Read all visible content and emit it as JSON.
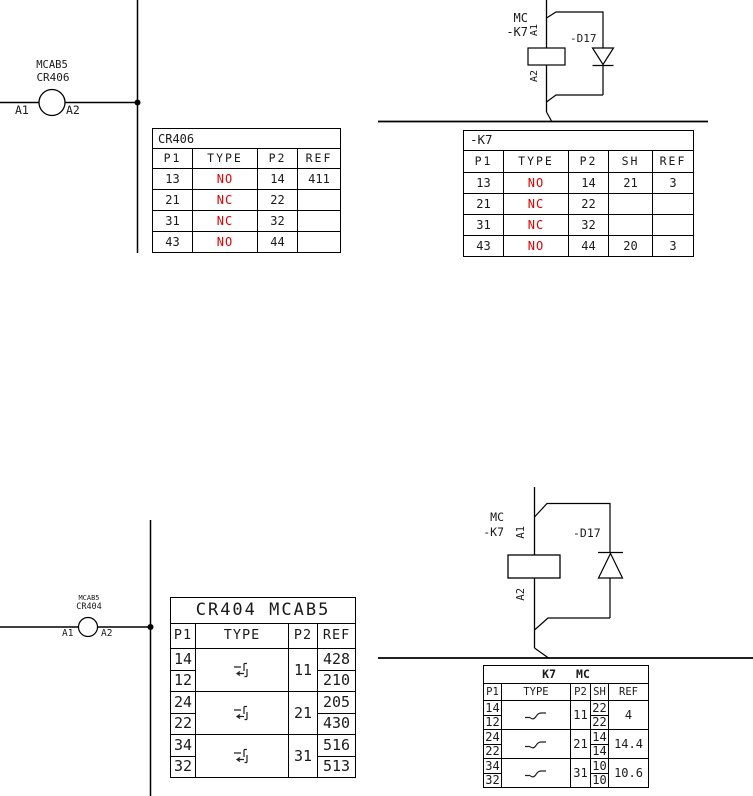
{
  "colors": {
    "wire": "#000000",
    "contact_state_red": "#e00000",
    "background": "#ffffff"
  },
  "coils": {
    "top_left": {
      "line1": "MCAB5",
      "line2": "CR406",
      "a1": "A1",
      "a2": "A2"
    },
    "top_right": {
      "line1": "MC",
      "line2": "-K7",
      "a1": "A1",
      "a2": "A2",
      "diode": "-D17"
    },
    "bottom_left": {
      "line1": "MCAB5",
      "line2": "CR404",
      "a1": "A1",
      "a2": "A2"
    },
    "bottom_right": {
      "line1": "MC",
      "line2": "-K7",
      "a1": "A1",
      "a2": "A2",
      "diode": "-D17"
    }
  },
  "tables": {
    "cr406": {
      "title": "CR406",
      "headers": [
        "P1",
        "TYPE",
        "P2",
        "REF"
      ],
      "rows": [
        {
          "p1": "13",
          "type": "NO",
          "p2": "14",
          "ref": "411"
        },
        {
          "p1": "21",
          "type": "NC",
          "p2": "22",
          "ref": ""
        },
        {
          "p1": "31",
          "type": "NC",
          "p2": "32",
          "ref": ""
        },
        {
          "p1": "43",
          "type": "NO",
          "p2": "44",
          "ref": ""
        }
      ]
    },
    "k7_top": {
      "title": "-K7",
      "headers": [
        "P1",
        "TYPE",
        "P2",
        "SH",
        "REF"
      ],
      "rows": [
        {
          "p1": "13",
          "type": "NO",
          "p2": "14",
          "sh": "21",
          "ref": "3"
        },
        {
          "p1": "21",
          "type": "NC",
          "p2": "22",
          "sh": "",
          "ref": ""
        },
        {
          "p1": "31",
          "type": "NC",
          "p2": "32",
          "sh": "",
          "ref": ""
        },
        {
          "p1": "43",
          "type": "NO",
          "p2": "44",
          "sh": "20",
          "ref": "3"
        }
      ]
    },
    "cr404": {
      "title": "CR404 MCAB5",
      "headers": [
        "P1",
        "TYPE",
        "P2",
        "REF"
      ],
      "type_symbol": "changeover-contact-icon",
      "groups": [
        {
          "p1_top": "14",
          "p1_bot": "12",
          "p2": "11",
          "ref_top": "428",
          "ref_bot": "210"
        },
        {
          "p1_top": "24",
          "p1_bot": "22",
          "p2": "21",
          "ref_top": "205",
          "ref_bot": "430"
        },
        {
          "p1_top": "34",
          "p1_bot": "32",
          "p2": "31",
          "ref_top": "516",
          "ref_bot": "513"
        }
      ]
    },
    "k7_bottom": {
      "title_left": "K7",
      "title_right": "MC",
      "headers": [
        "P1",
        "TYPE",
        "P2",
        "SH",
        "REF"
      ],
      "type_symbol": "no-contact-icon",
      "groups": [
        {
          "p1_top": "14",
          "p1_bot": "12",
          "p2": "11",
          "sh_top": "22",
          "sh_bot": "22",
          "ref": "4"
        },
        {
          "p1_top": "24",
          "p1_bot": "22",
          "p2": "21",
          "sh_top": "14",
          "sh_bot": "14",
          "ref": "14.4"
        },
        {
          "p1_top": "34",
          "p1_bot": "32",
          "p2": "31",
          "sh_top": "10",
          "sh_bot": "10",
          "ref": "10.6"
        }
      ]
    }
  }
}
